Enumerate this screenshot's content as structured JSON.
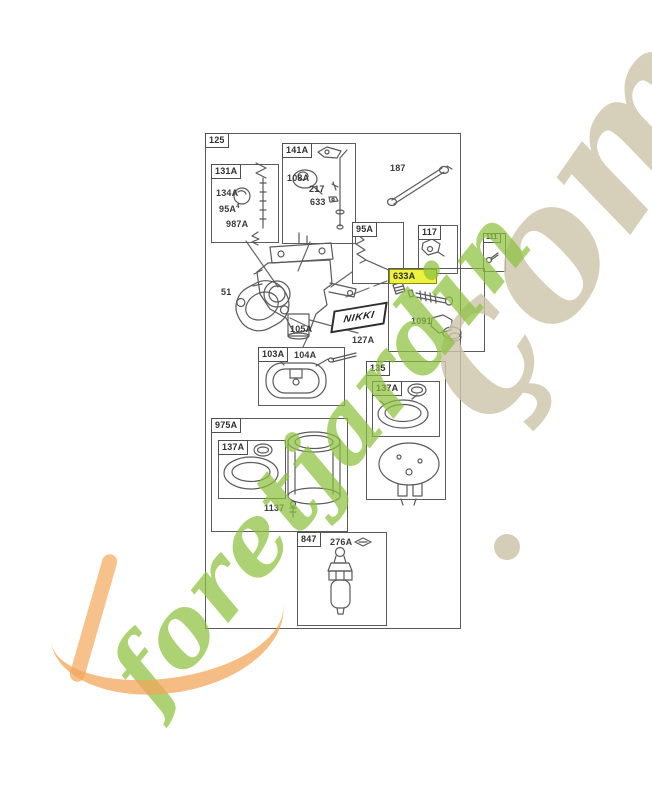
{
  "watermark": {
    "word": "foretjardin",
    "suffix": "çom"
  },
  "brand_logo": "NIKKI",
  "colors": {
    "highlight_yellow": "#eef23a",
    "watermark_green": "#8cc13d",
    "watermark_tan": "#cdc4aa",
    "watermark_orange": "#f2a65a",
    "line_gray": "#565656"
  },
  "diagram": {
    "root_label": "125",
    "boxes": {
      "b131A": "131A",
      "b141A": "141A",
      "b95A": "95A",
      "b117": "117",
      "b111": "111",
      "b633A": "633A",
      "b103A": "103A",
      "b135": "135",
      "b137A_in_135": "137A",
      "b975A": "975A",
      "b137A_in_975A": "137A",
      "b847": "847"
    },
    "labels": {
      "l134A": "134A",
      "l95A": "95A",
      "sup4": "4",
      "l987A": "987A",
      "l108A": "108A",
      "l217": "217",
      "l633": "633",
      "l187": "187",
      "l51": "51",
      "l105A": "105A",
      "l127A": "127A",
      "l1091": "1091",
      "l104A": "104A",
      "l1137": "1137",
      "l276A": "276A"
    }
  }
}
